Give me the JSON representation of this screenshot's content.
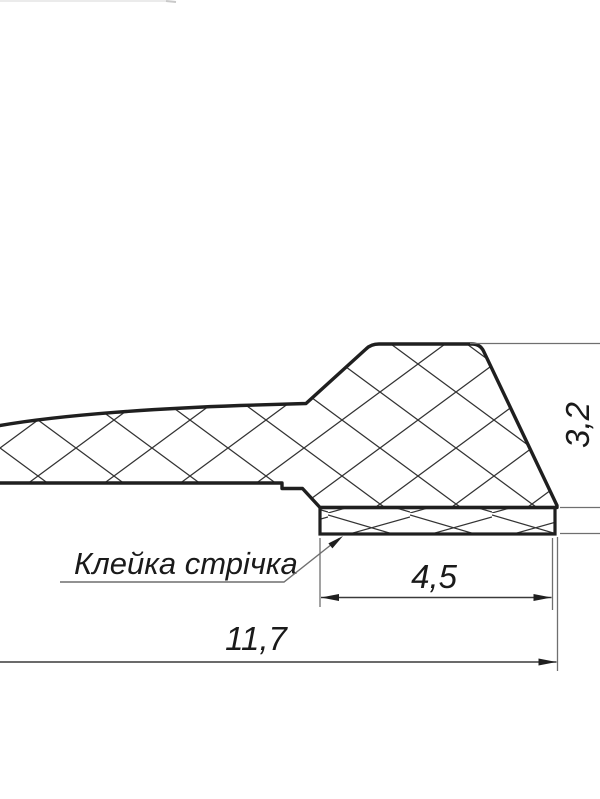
{
  "drawing": {
    "type": "technical-cross-section",
    "callout": {
      "label": "Клейка стрічка"
    },
    "dimensions": [
      {
        "id": "tape-width",
        "value": "4,5"
      },
      {
        "id": "overall-length",
        "value": "11,7"
      },
      {
        "id": "profile-height",
        "value": "3,2"
      }
    ],
    "colors": {
      "outline": "#1f1f1f",
      "hatch": "#333333",
      "thin_line": "#6f6f6f",
      "text": "#1a1a1a",
      "background": "#ffffff"
    }
  }
}
